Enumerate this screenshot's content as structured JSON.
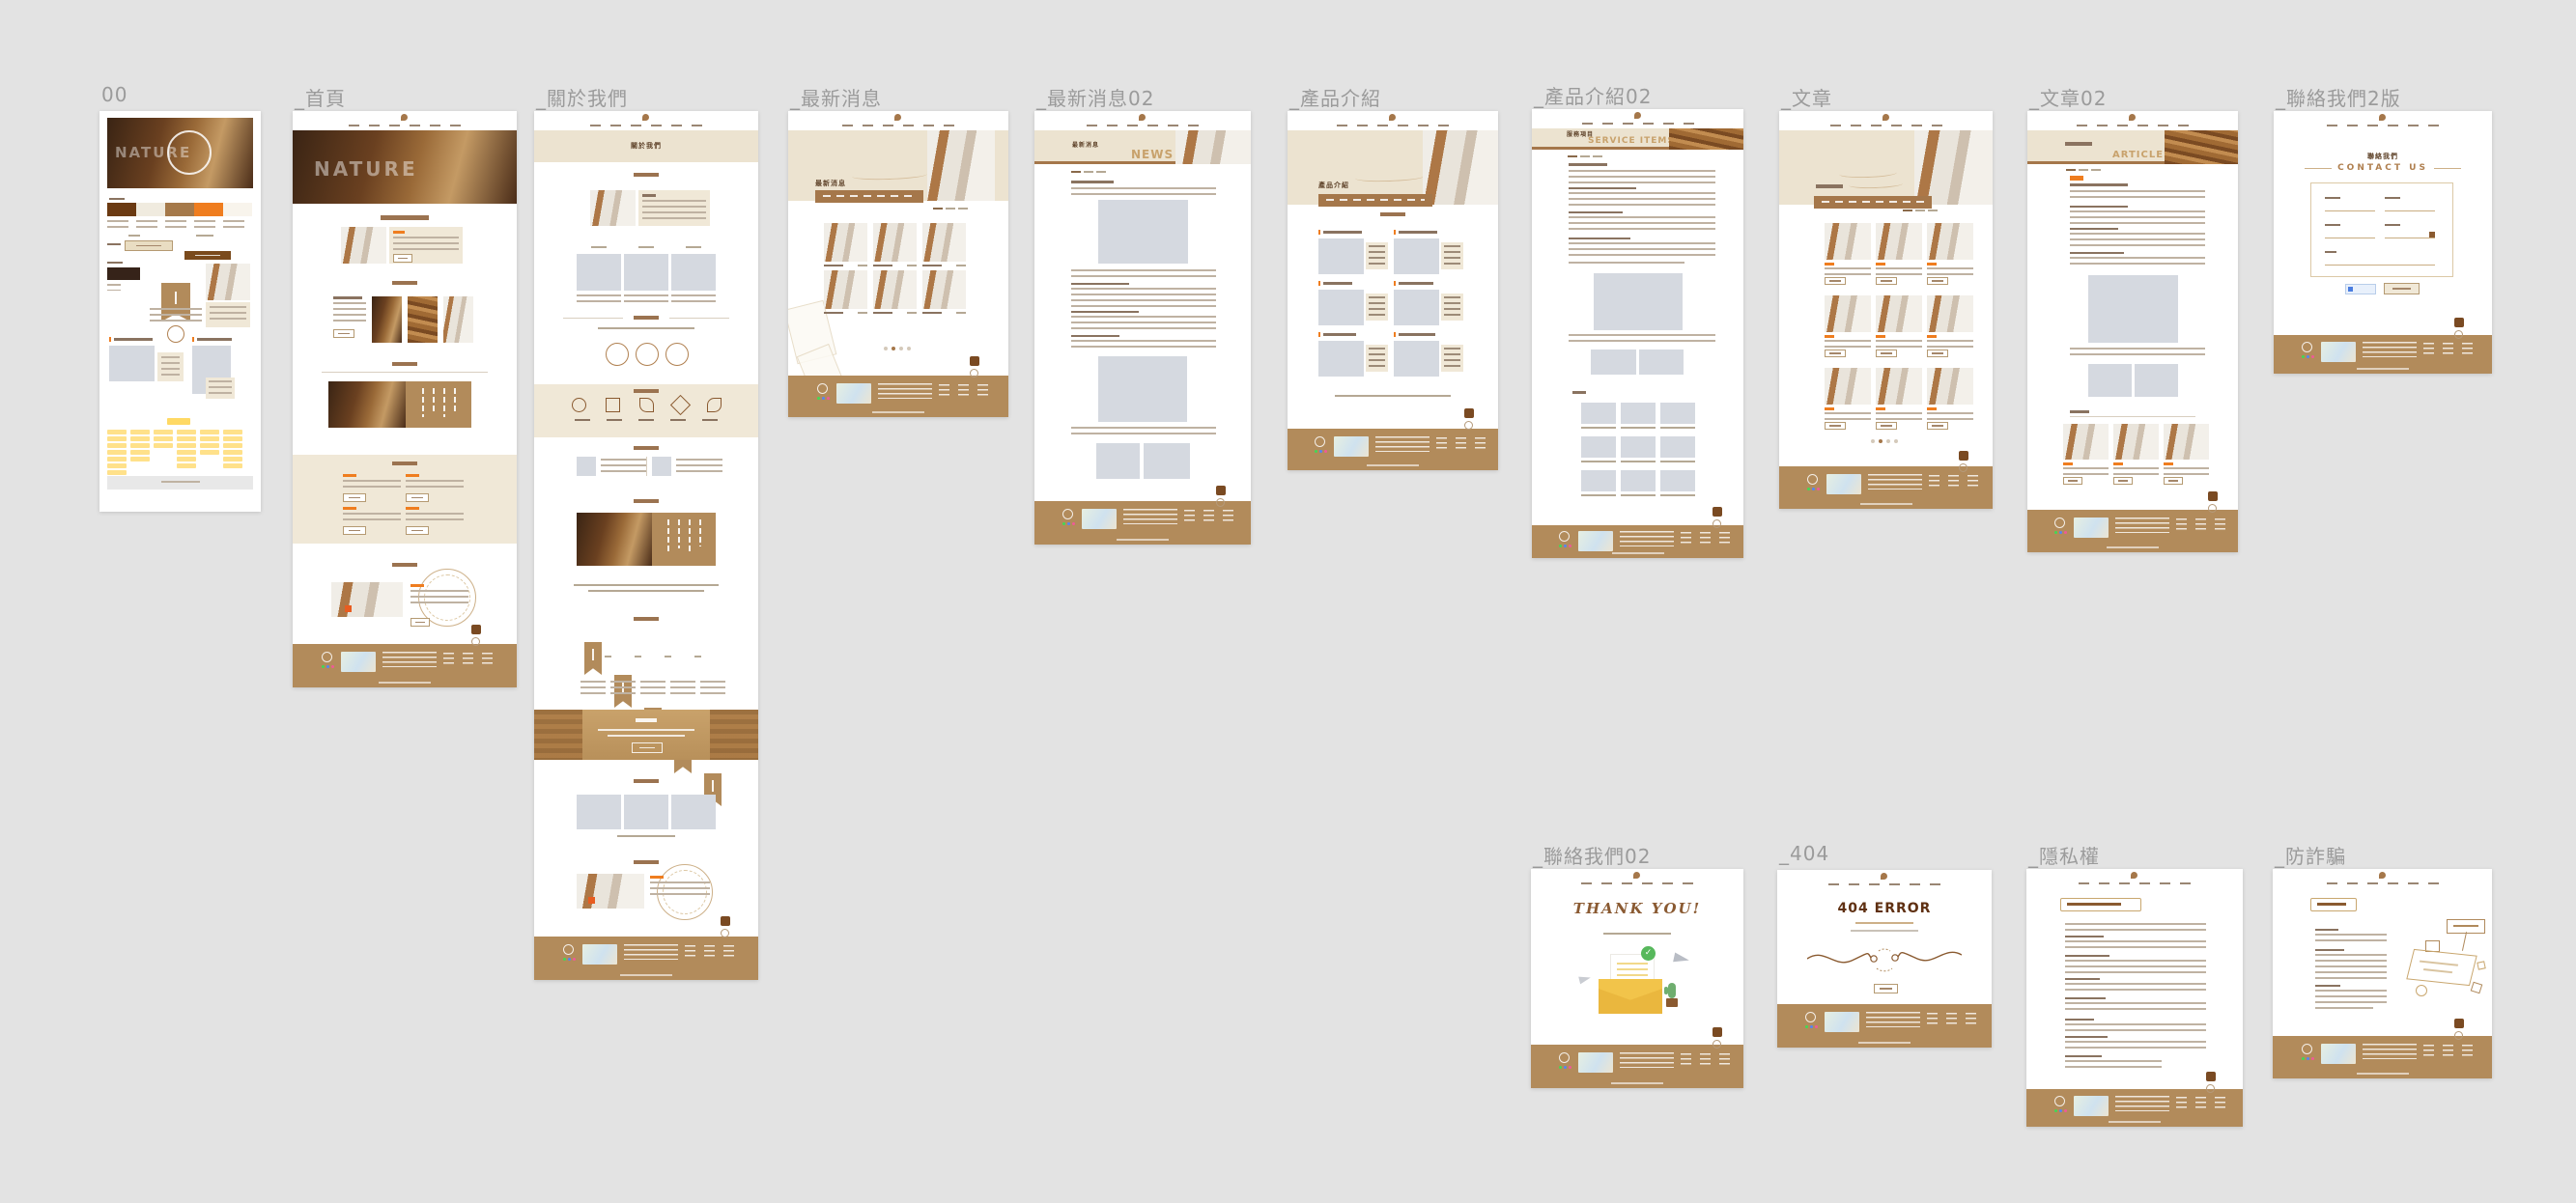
{
  "canvas": {
    "background": "#e3e3e3",
    "tool": "design-canvas"
  },
  "frames": [
    {
      "name": "styleguide",
      "label": "00"
    },
    {
      "name": "home",
      "label": "_首頁"
    },
    {
      "name": "about",
      "label": "_關於我們"
    },
    {
      "name": "news-list",
      "label": "_最新消息"
    },
    {
      "name": "news-detail",
      "label": "_最新消息02"
    },
    {
      "name": "products",
      "label": "_產品介紹"
    },
    {
      "name": "products-detail",
      "label": "_產品介紹02"
    },
    {
      "name": "articles",
      "label": "_文章"
    },
    {
      "name": "articles-detail",
      "label": "_文章02"
    },
    {
      "name": "contact-v2",
      "label": "_聯絡我們2版"
    },
    {
      "name": "contact-thanks",
      "label": "_聯絡我們02"
    },
    {
      "name": "error-404",
      "label": "_404"
    },
    {
      "name": "privacy",
      "label": "_隱私權"
    },
    {
      "name": "anti-fraud",
      "label": "_防詐騙"
    }
  ],
  "texts": {
    "brand": "NATURE",
    "about_title": "關於我們",
    "news_title": "最新消息",
    "news_en": "NEWS",
    "products_title": "產品介紹",
    "service_title": "服務項目",
    "service_en": "SERVICE ITEMS",
    "articles_en": "ARTICLES",
    "contact_title": "聯絡我們",
    "contact_en": "CONTACT US",
    "thanks_en": "THANK YOU!",
    "error_title": "404 ERROR"
  },
  "styleguide": {
    "palette": [
      "#6b3a12",
      "#f0ebdf",
      "#a5794a",
      "#ef7d1f",
      "#f8f4ec"
    ],
    "dark_swatch": "#362319",
    "accent_orange": "#ef7d1f",
    "footer_brown": "#b28b5b",
    "banner_beige": "#ece3d0",
    "sitemap_yellow": "#ffe18a",
    "placeholder_gray": "#d5d9e0"
  }
}
